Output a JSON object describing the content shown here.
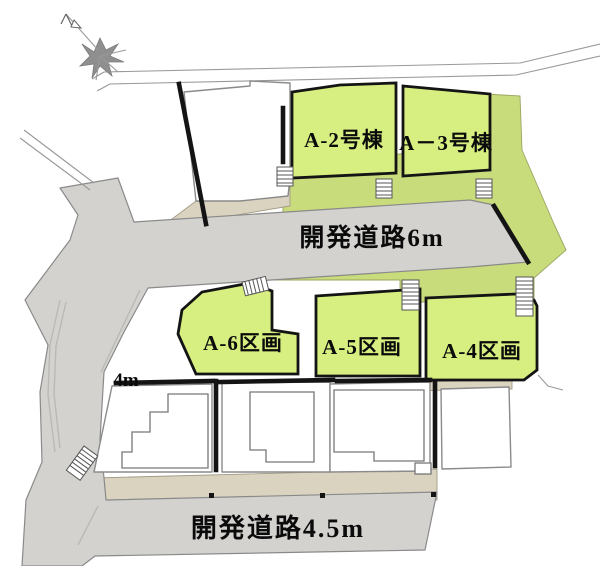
{
  "map": {
    "compass": {
      "icon": "north-arrow-icon"
    },
    "buildings": [
      {
        "id": "A-2",
        "label": "A-2号棟"
      },
      {
        "id": "A-3",
        "label": "A－3号棟"
      }
    ],
    "parcels": [
      {
        "id": "A-6",
        "label": "A-6区画"
      },
      {
        "id": "A-5",
        "label": "A-5区画"
      },
      {
        "id": "A-4",
        "label": "A-4区画"
      }
    ],
    "roads": [
      {
        "id": "dev-road-6m",
        "label": "開発道路6m"
      },
      {
        "id": "dev-road-4.5m",
        "label": "開発道路4.5m"
      },
      {
        "id": "side-road-4m",
        "label": "4m"
      }
    ],
    "palette": {
      "lot_green": "#d7ef80",
      "strip_green": "#c9dc7b",
      "road_gray": "#d3d2cf",
      "sidewalk_beige": "#d9d3c0",
      "border_black": "#141414",
      "outline_gray": "#8a8a8a",
      "compass_gray": "#8f8f8f",
      "building_white": "#ffffff"
    }
  }
}
